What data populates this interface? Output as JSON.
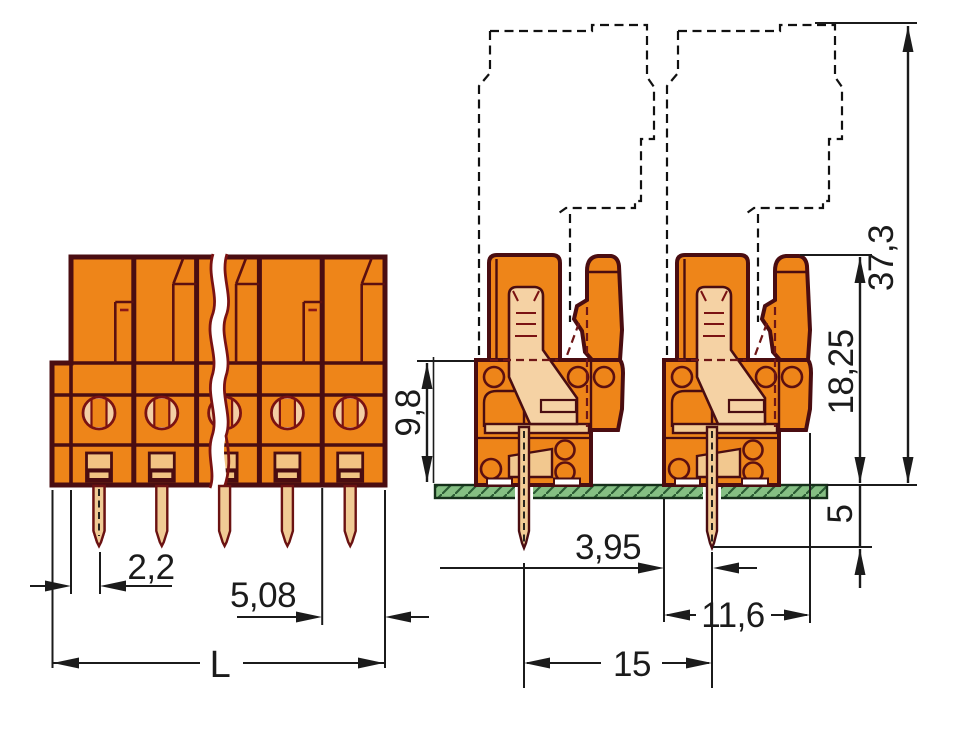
{
  "drawing": {
    "front_view": {
      "dimensions": {
        "pin_offset": "2,2",
        "pitch": "5,08",
        "total_length": "L"
      }
    },
    "side_view": {
      "dimensions": {
        "total_height": "37,3",
        "height_above_board": "18,25",
        "body_height": "9,8",
        "pin_length_below_board": "5",
        "pin_offset_from_edge": "3,95",
        "body_depth": "11,6",
        "row_spacing": "15"
      }
    },
    "colors": {
      "body_orange": "#EE8519",
      "outline_maroon": "#4A0D11",
      "contact_tan": "#F3CC96",
      "pcb_green": "#85BF83",
      "dimension_black": "#1B1B1B"
    }
  }
}
